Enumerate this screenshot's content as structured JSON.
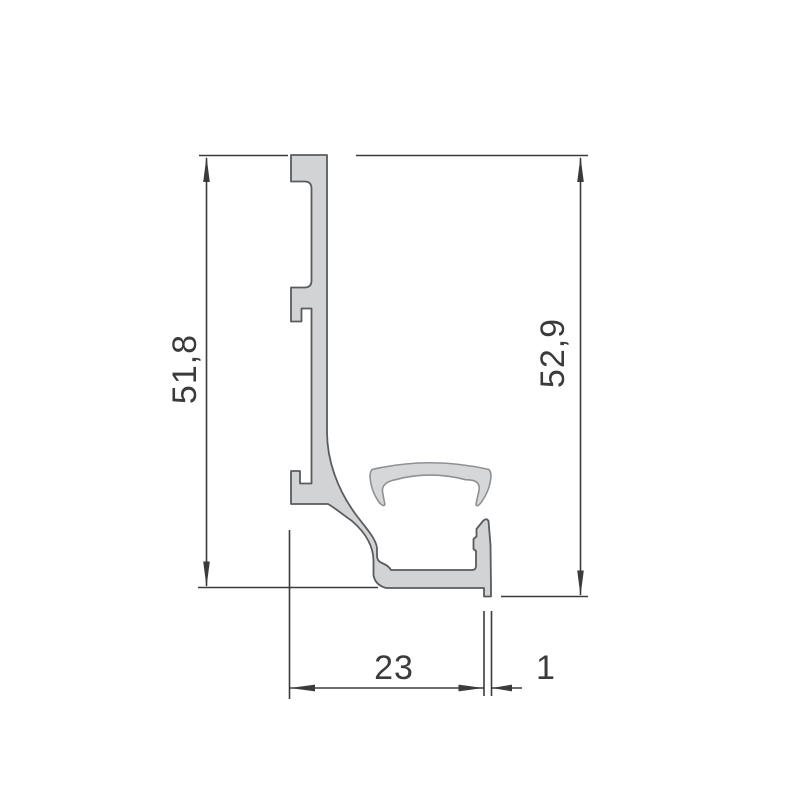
{
  "diagram": {
    "kind": "technical-drawing",
    "subject": "aluminium-profile-cross-section-with-clip-insert",
    "units": "mm",
    "colors": {
      "background": "#ffffff",
      "profile_fill": "#d2d3d5",
      "profile_stroke": "#595b5e",
      "clip_stroke": "#8e9194",
      "dimension_color": "#3a3b3c"
    },
    "dimensions": {
      "left_height": "51,8",
      "right_height": "52,9",
      "base_width": "23",
      "foot_thickness": "1"
    },
    "geometry": {
      "profile_path": "M 291 155 L 327 155 L 327 432 C 327 458 336 490 360 520 C 368 530 377 541 377 549 L 377 556 Q 377 561 382 563 Q 389 566 391 570 L 472 570 Q 476 570 476 566 L 476 551 L 473.5 549 L 473.5 539 L 476.5 536.5 L 476.5 529 L 483 521 Q 486.5 517.5 488.5 521 L 490.5 545 L 491 587.5 L 491 596.5 L 484 596.5 L 484 588 L 386 588 Q 375 585 373.5 575 L 373.5 561 C 373.5 548 367 534 352 521 C 342 514 335 508 328 504 L 291 504 L 291 471 L 300 471 L 300 483.5 L 311.5 483.5 L 311.5 308.5 L 301.5 308.5 L 301.5 321.5 L 291 321.5 L 291 287.5 L 304.5 287.5 Q 311.5 287.5 311.5 280.5 L 311.5 188.5 Q 311.5 181.5 304.5 181.5 L 291 181.5 Z",
      "clip_path": "M 372 469.5 Q 430 456 489 469.5 C 491 472 491.5 477 490 483 C 489 489 486 495 482.5 500.5 Q 480 504.5 477.8 505.5 Q 475.5 506.3 476.2 503.2 Q 477.2 498 478.6 492.5 C 480.2 486 479 481.5 471.5 480.2 Q 468.5 479.7 465.5 479.7 Q 430 470.5 395.5 479.7 C 387.5 481.2 381.5 485 382.6 492 Q 383.6 498.5 384.6 502.8 Q 385.3 506.3 382.8 505.4 Q 380.3 504.4 377.8 500.3 C 374.3 495 371.8 488.5 370.8 483 C 369.8 477 369.5 472.5 372 469.5 Z"
    }
  }
}
